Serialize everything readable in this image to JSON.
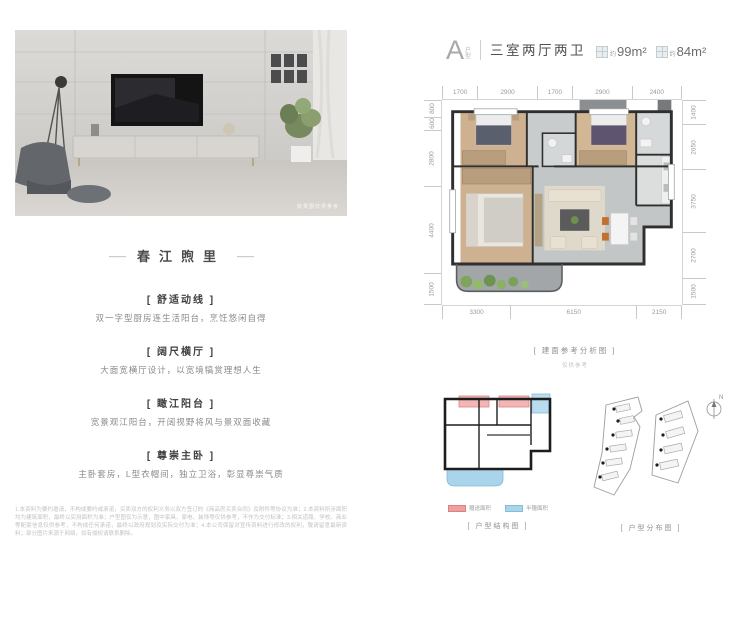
{
  "header": {
    "type_letter": "A",
    "type_sub": "户型",
    "rooms": "三室两厅两卫",
    "area1_about": "约",
    "area1": "99m²",
    "area2_about": "约",
    "area2": "84m²"
  },
  "left": {
    "photo_caption": "效果图仅供参考",
    "brand": {
      "dash": "——",
      "name": "春江煦里"
    },
    "features": [
      {
        "title": "[ 舒适动线 ]",
        "desc": "双一字型厨房连生活阳台，烹饪悠闲自得"
      },
      {
        "title": "[ 阔尺横厅 ]",
        "desc": "大面宽横厅设计，以宽境犒赏理想人生"
      },
      {
        "title": "[ 瞰江阳台 ]",
        "desc": "宽景观江阳台，开阔视野将风与景双面收藏"
      },
      {
        "title": "[ 尊崇主卧 ]",
        "desc": "主卧套房，L型衣帽间，独立卫浴，彰显尊崇气质"
      }
    ],
    "disclaimer": "1.本资料为要约邀请，不构成要约或承诺，买卖双方的权利义务以双方签订的《商品房买卖合同》及附件等协议为准；2.本资料所涉面积均为建筑面积，最终以实测面积为准；户型图仅为示意，图中家具、家电、装饰等仅供参考，不作为交付标准；3.相关道路、学校、商业等配套信息仅供参考，不构成任何承诺，最终以政府规划及实际交付为准；4.本公司保留对宣传资料进行修改的权利，敬请留意最新资料；部分图片来源于网络，如有侵权请联系删除。"
  },
  "plan": {
    "dims_top": [
      "1700",
      "2900",
      "1700",
      "2900",
      "2400"
    ],
    "dims_left": [
      "800",
      "600",
      "2800",
      "4400",
      "1500"
    ],
    "dims_right": [
      "1400",
      "2650",
      "3750",
      "2700",
      "1500"
    ],
    "dims_bottom": [
      "3300",
      "6150",
      "2150"
    ],
    "caption": "[ 建面参考分析图 ]",
    "caption_sub": "仅供参考"
  },
  "diagrams": {
    "structure": {
      "caption": "[ 户型结构图 ]",
      "legend": [
        {
          "color": "#ef9f9f",
          "label": "赠送面积"
        },
        {
          "color": "#a9d4ea",
          "label": "半赠面积"
        }
      ]
    },
    "distribution": {
      "caption": "[ 户型分布图 ]",
      "compass": "N"
    }
  },
  "colors": {
    "wall": "#333333",
    "wood_floor": "#cdb190",
    "tile_floor": "#c3c6c7",
    "balcony_floor": "#a2a6a8",
    "plant_green": "#84a95e",
    "accent_red": "#ef9f9f",
    "accent_blue": "#a9d4ea"
  }
}
